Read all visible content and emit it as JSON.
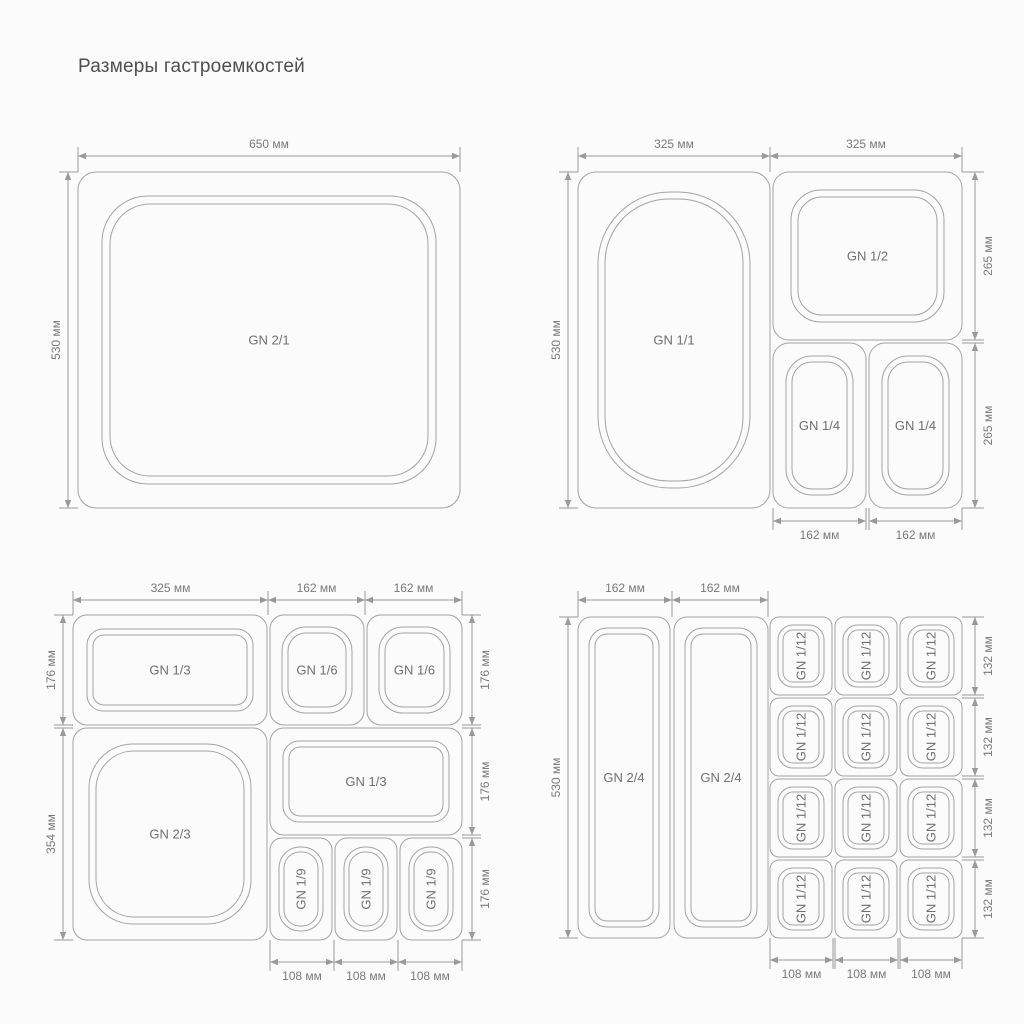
{
  "title": "Размеры гастроемкостей",
  "colors": {
    "line": "#a3a3a3",
    "dim": "#9a9a9a",
    "container_text": "#707070",
    "dim_text": "#7a7a7a",
    "title_text": "#4f4f4f",
    "bg": "#fbfbfb"
  },
  "diagrams": [
    {
      "name": "quadrant-gn21",
      "containers": [
        {
          "name": "gn-2-1",
          "label": "GN 2/1",
          "x": 78,
          "y": 172,
          "w": 382,
          "h": 336,
          "r": 18,
          "rot": false,
          "rings": [
            {
              "i": 24,
              "r": 46
            },
            {
              "i": 32,
              "r": 40
            }
          ]
        }
      ],
      "h_dims": [
        {
          "x1": 78,
          "x2": 460,
          "y": 156,
          "label": "650 мм",
          "ext": 172,
          "pos": "above"
        }
      ],
      "v_dims": [
        {
          "x": 68,
          "y1": 172,
          "y2": 508,
          "label": "530 мм",
          "ext": 78,
          "side": "left"
        }
      ]
    },
    {
      "name": "quadrant-gn11",
      "containers": [
        {
          "name": "gn-1-1",
          "label": "GN 1/1",
          "x": 578,
          "y": 172,
          "w": 192,
          "h": 336,
          "r": 18,
          "rot": false,
          "rings": [
            {
              "i": 20,
              "r": 72
            },
            {
              "i": 27,
              "r": 64
            }
          ]
        },
        {
          "name": "gn-1-2",
          "label": "GN 1/2",
          "x": 773,
          "y": 172,
          "w": 189,
          "h": 168,
          "r": 16,
          "rot": false,
          "rings": [
            {
              "i": 18,
              "r": 30
            },
            {
              "i": 25,
              "r": 24
            }
          ]
        },
        {
          "name": "gn-1-4-a",
          "label": "GN 1/4",
          "x": 773,
          "y": 343,
          "w": 93,
          "h": 165,
          "r": 16,
          "rot": false,
          "rings": [
            {
              "i": 13,
              "r": 26
            },
            {
              "i": 19,
              "r": 20
            }
          ]
        },
        {
          "name": "gn-1-4-b",
          "label": "GN 1/4",
          "x": 869,
          "y": 343,
          "w": 93,
          "h": 165,
          "r": 16,
          "rot": false,
          "rings": [
            {
              "i": 13,
              "r": 26
            },
            {
              "i": 19,
              "r": 20
            }
          ]
        }
      ],
      "h_dims": [
        {
          "x1": 578,
          "x2": 770,
          "y": 156,
          "label": "325 мм",
          "ext": 172,
          "pos": "above"
        },
        {
          "x1": 770,
          "x2": 962,
          "y": 156,
          "label": "325 мм",
          "ext": 172,
          "pos": "above"
        },
        {
          "x1": 773,
          "x2": 866,
          "y": 521,
          "label": "162 мм",
          "ext": 508,
          "pos": "below"
        },
        {
          "x1": 869,
          "x2": 962,
          "y": 521,
          "label": "162 мм",
          "ext": 508,
          "pos": "below"
        }
      ],
      "v_dims": [
        {
          "x": 568,
          "y1": 172,
          "y2": 508,
          "label": "530 мм",
          "ext": 578,
          "side": "left"
        },
        {
          "x": 975,
          "y1": 172,
          "y2": 340,
          "label": "265 мм",
          "ext": 962,
          "side": "right"
        },
        {
          "x": 975,
          "y1": 343,
          "y2": 508,
          "label": "265 мм",
          "ext": 962,
          "side": "right"
        }
      ]
    },
    {
      "name": "quadrant-gn23",
      "containers": [
        {
          "name": "gn-1-3-top",
          "label": "GN 1/3",
          "x": 73,
          "y": 615,
          "w": 194,
          "h": 110,
          "r": 14,
          "rot": false,
          "rings": [
            {
              "i": 14,
              "r": 16
            },
            {
              "i": 20,
              "r": 11
            }
          ]
        },
        {
          "name": "gn-1-6-a",
          "label": "GN 1/6",
          "x": 270,
          "y": 615,
          "w": 94,
          "h": 110,
          "r": 14,
          "rot": false,
          "rings": [
            {
              "i": 12,
              "r": 24
            },
            {
              "i": 18,
              "r": 18
            }
          ]
        },
        {
          "name": "gn-1-6-b",
          "label": "GN 1/6",
          "x": 367,
          "y": 615,
          "w": 95,
          "h": 110,
          "r": 14,
          "rot": false,
          "rings": [
            {
              "i": 12,
              "r": 24
            },
            {
              "i": 18,
              "r": 18
            }
          ]
        },
        {
          "name": "gn-2-3",
          "label": "GN 2/3",
          "x": 73,
          "y": 728,
          "w": 194,
          "h": 212,
          "r": 14,
          "rot": false,
          "rings": [
            {
              "i": 16,
              "r": 44
            },
            {
              "i": 23,
              "r": 38
            }
          ]
        },
        {
          "name": "gn-1-3-bottom",
          "label": "GN 1/3",
          "x": 270,
          "y": 728,
          "w": 192,
          "h": 107,
          "r": 14,
          "rot": false,
          "rings": [
            {
              "i": 13,
              "r": 16
            },
            {
              "i": 19,
              "r": 11
            }
          ]
        },
        {
          "name": "gn-1-9-a",
          "label": "GN 1/9",
          "x": 270,
          "y": 838,
          "w": 62,
          "h": 102,
          "r": 12,
          "rot": true,
          "rings": [
            {
              "i": 9,
              "r": 21
            },
            {
              "i": 14,
              "r": 16
            }
          ]
        },
        {
          "name": "gn-1-9-b",
          "label": "GN 1/9",
          "x": 335,
          "y": 838,
          "w": 62,
          "h": 102,
          "r": 12,
          "rot": true,
          "rings": [
            {
              "i": 9,
              "r": 21
            },
            {
              "i": 14,
              "r": 16
            }
          ]
        },
        {
          "name": "gn-1-9-c",
          "label": "GN 1/9",
          "x": 400,
          "y": 838,
          "w": 62,
          "h": 102,
          "r": 12,
          "rot": true,
          "rings": [
            {
              "i": 9,
              "r": 21
            },
            {
              "i": 14,
              "r": 16
            }
          ]
        }
      ],
      "h_dims": [
        {
          "x1": 73,
          "x2": 268,
          "y": 600,
          "label": "325 мм",
          "ext": 615,
          "pos": "above"
        },
        {
          "x1": 268,
          "x2": 365,
          "y": 600,
          "label": "162 мм",
          "ext": 615,
          "pos": "above"
        },
        {
          "x1": 365,
          "x2": 462,
          "y": 600,
          "label": "162 мм",
          "ext": 615,
          "pos": "above"
        },
        {
          "x1": 270,
          "x2": 334,
          "y": 962,
          "label": "108 мм",
          "ext": 940,
          "pos": "below"
        },
        {
          "x1": 334,
          "x2": 398,
          "y": 962,
          "label": "108 мм",
          "ext": 940,
          "pos": "below"
        },
        {
          "x1": 398,
          "x2": 462,
          "y": 962,
          "label": "108 мм",
          "ext": 940,
          "pos": "below"
        }
      ],
      "v_dims": [
        {
          "x": 63,
          "y1": 615,
          "y2": 725,
          "label": "176 мм",
          "ext": 73,
          "side": "left"
        },
        {
          "x": 63,
          "y1": 728,
          "y2": 940,
          "label": "354 мм",
          "ext": 73,
          "side": "left"
        },
        {
          "x": 472,
          "y1": 615,
          "y2": 725,
          "label": "176 мм",
          "ext": 462,
          "side": "right"
        },
        {
          "x": 472,
          "y1": 728,
          "y2": 835,
          "label": "176 мм",
          "ext": 462,
          "side": "right"
        },
        {
          "x": 472,
          "y1": 838,
          "y2": 940,
          "label": "176 мм",
          "ext": 462,
          "side": "right"
        }
      ]
    },
    {
      "name": "quadrant-gn24",
      "containers": [
        {
          "name": "gn-2-4-a",
          "label": "GN 2/4",
          "x": 578,
          "y": 617,
          "w": 92,
          "h": 321,
          "r": 13,
          "rot": false,
          "rings": [
            {
              "i": 11,
              "r": 18
            },
            {
              "i": 17,
              "r": 12
            }
          ]
        },
        {
          "name": "gn-2-4-b",
          "label": "GN 2/4",
          "x": 674,
          "y": 617,
          "w": 94,
          "h": 321,
          "r": 13,
          "rot": false,
          "rings": [
            {
              "i": 11,
              "r": 18
            },
            {
              "i": 17,
              "r": 12
            }
          ]
        },
        {
          "name": "gn-1-12-r1c1",
          "label": "GN 1/12",
          "x": 770,
          "y": 617,
          "w": 62,
          "h": 78,
          "r": 9,
          "rot": true,
          "rings": [
            {
              "i": 8,
              "r": 15
            },
            {
              "i": 13,
              "r": 10
            }
          ]
        },
        {
          "name": "gn-1-12-r1c2",
          "label": "GN 1/12",
          "x": 835,
          "y": 617,
          "w": 62,
          "h": 78,
          "r": 9,
          "rot": true,
          "rings": [
            {
              "i": 8,
              "r": 15
            },
            {
              "i": 13,
              "r": 10
            }
          ]
        },
        {
          "name": "gn-1-12-r1c3",
          "label": "GN 1/12",
          "x": 900,
          "y": 617,
          "w": 62,
          "h": 78,
          "r": 9,
          "rot": true,
          "rings": [
            {
              "i": 8,
              "r": 15
            },
            {
              "i": 13,
              "r": 10
            }
          ]
        },
        {
          "name": "gn-1-12-r2c1",
          "label": "GN 1/12",
          "x": 770,
          "y": 698,
          "w": 62,
          "h": 78,
          "r": 9,
          "rot": true,
          "rings": [
            {
              "i": 8,
              "r": 15
            },
            {
              "i": 13,
              "r": 10
            }
          ]
        },
        {
          "name": "gn-1-12-r2c2",
          "label": "GN 1/12",
          "x": 835,
          "y": 698,
          "w": 62,
          "h": 78,
          "r": 9,
          "rot": true,
          "rings": [
            {
              "i": 8,
              "r": 15
            },
            {
              "i": 13,
              "r": 10
            }
          ]
        },
        {
          "name": "gn-1-12-r2c3",
          "label": "GN 1/12",
          "x": 900,
          "y": 698,
          "w": 62,
          "h": 78,
          "r": 9,
          "rot": true,
          "rings": [
            {
              "i": 8,
              "r": 15
            },
            {
              "i": 13,
              "r": 10
            }
          ]
        },
        {
          "name": "gn-1-12-r3c1",
          "label": "GN 1/12",
          "x": 770,
          "y": 779,
          "w": 62,
          "h": 78,
          "r": 9,
          "rot": true,
          "rings": [
            {
              "i": 8,
              "r": 15
            },
            {
              "i": 13,
              "r": 10
            }
          ]
        },
        {
          "name": "gn-1-12-r3c2",
          "label": "GN 1/12",
          "x": 835,
          "y": 779,
          "w": 62,
          "h": 78,
          "r": 9,
          "rot": true,
          "rings": [
            {
              "i": 8,
              "r": 15
            },
            {
              "i": 13,
              "r": 10
            }
          ]
        },
        {
          "name": "gn-1-12-r3c3",
          "label": "GN 1/12",
          "x": 900,
          "y": 779,
          "w": 62,
          "h": 78,
          "r": 9,
          "rot": true,
          "rings": [
            {
              "i": 8,
              "r": 15
            },
            {
              "i": 13,
              "r": 10
            }
          ]
        },
        {
          "name": "gn-1-12-r4c1",
          "label": "GN 1/12",
          "x": 770,
          "y": 860,
          "w": 62,
          "h": 78,
          "r": 9,
          "rot": true,
          "rings": [
            {
              "i": 8,
              "r": 15
            },
            {
              "i": 13,
              "r": 10
            }
          ]
        },
        {
          "name": "gn-1-12-r4c2",
          "label": "GN 1/12",
          "x": 835,
          "y": 860,
          "w": 62,
          "h": 78,
          "r": 9,
          "rot": true,
          "rings": [
            {
              "i": 8,
              "r": 15
            },
            {
              "i": 13,
              "r": 10
            }
          ]
        },
        {
          "name": "gn-1-12-r4c3",
          "label": "GN 1/12",
          "x": 900,
          "y": 860,
          "w": 62,
          "h": 78,
          "r": 9,
          "rot": true,
          "rings": [
            {
              "i": 8,
              "r": 15
            },
            {
              "i": 13,
              "r": 10
            }
          ]
        }
      ],
      "h_dims": [
        {
          "x1": 578,
          "x2": 672,
          "y": 600,
          "label": "162 мм",
          "ext": 617,
          "pos": "above"
        },
        {
          "x1": 672,
          "x2": 768,
          "y": 600,
          "label": "162 мм",
          "ext": 617,
          "pos": "above"
        },
        {
          "x1": 770,
          "x2": 833,
          "y": 960,
          "label": "108 мм",
          "ext": 938,
          "pos": "below"
        },
        {
          "x1": 835,
          "x2": 898,
          "y": 960,
          "label": "108 мм",
          "ext": 938,
          "pos": "below"
        },
        {
          "x1": 900,
          "x2": 962,
          "y": 960,
          "label": "108 мм",
          "ext": 938,
          "pos": "below"
        }
      ],
      "v_dims": [
        {
          "x": 568,
          "y1": 617,
          "y2": 938,
          "label": "530 мм",
          "ext": 578,
          "side": "left"
        },
        {
          "x": 975,
          "y1": 617,
          "y2": 695,
          "label": "132 мм",
          "ext": 962,
          "side": "right"
        },
        {
          "x": 975,
          "y1": 698,
          "y2": 776,
          "label": "132 мм",
          "ext": 962,
          "side": "right"
        },
        {
          "x": 975,
          "y1": 779,
          "y2": 857,
          "label": "132 мм",
          "ext": 962,
          "side": "right"
        },
        {
          "x": 975,
          "y1": 860,
          "y2": 938,
          "label": "132 мм",
          "ext": 962,
          "side": "right"
        }
      ]
    }
  ]
}
